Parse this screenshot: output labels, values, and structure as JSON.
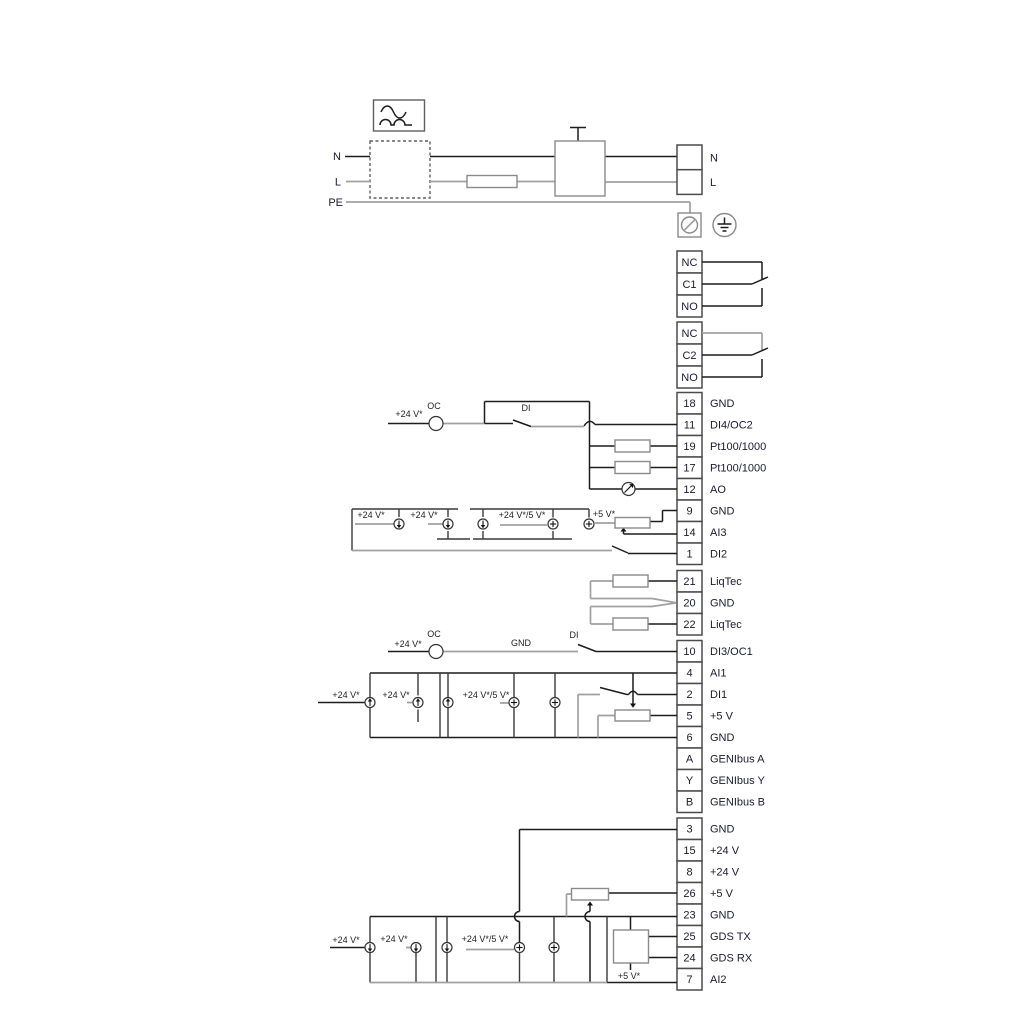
{
  "power": {
    "line_n": "N",
    "line_l": "L",
    "line_pe": "PE",
    "terminal_n": "N",
    "terminal_l": "L"
  },
  "relays": [
    {
      "cells": [
        "NC",
        "C1",
        "NO"
      ]
    },
    {
      "cells": [
        "NC",
        "C2",
        "NO"
      ]
    }
  ],
  "io": {
    "block1": [
      {
        "no": "18",
        "label": "GND"
      },
      {
        "no": "11",
        "label": "DI4/OC2"
      },
      {
        "no": "19",
        "label": "Pt100/1000"
      },
      {
        "no": "17",
        "label": "Pt100/1000"
      },
      {
        "no": "12",
        "label": "AO"
      },
      {
        "no": "9",
        "label": "GND"
      },
      {
        "no": "14",
        "label": "AI3"
      },
      {
        "no": "1",
        "label": "DI2"
      }
    ],
    "liqtec": [
      {
        "no": "21",
        "label": "LiqTec"
      },
      {
        "no": "20",
        "label": "GND"
      },
      {
        "no": "22",
        "label": "LiqTec"
      }
    ],
    "block2": [
      {
        "no": "10",
        "label": "DI3/OC1"
      },
      {
        "no": "4",
        "label": "AI1"
      },
      {
        "no": "2",
        "label": "DI1"
      },
      {
        "no": "5",
        "label": "+5 V"
      },
      {
        "no": "6",
        "label": "GND"
      },
      {
        "no": "A",
        "label": "GENIbus A"
      },
      {
        "no": "Y",
        "label": "GENIbus Y"
      },
      {
        "no": "B",
        "label": "GENIbus B"
      }
    ],
    "block3": [
      {
        "no": "3",
        "label": "GND"
      },
      {
        "no": "15",
        "label": "+24 V"
      },
      {
        "no": "8",
        "label": "+24 V"
      },
      {
        "no": "26",
        "label": "+5 V"
      },
      {
        "no": "23",
        "label": "GND"
      },
      {
        "no": "25",
        "label": "GDS TX"
      },
      {
        "no": "24",
        "label": "GDS RX"
      },
      {
        "no": "7",
        "label": "AI2"
      }
    ]
  },
  "labels": {
    "v24": "+24 V*",
    "v24_5": "+24 V*/5 V*",
    "v5": "+5 V*",
    "oc": "OC",
    "di": "DI",
    "gnd": "GND"
  },
  "colors": {
    "wire_dark": "#1c1c1c",
    "wire_gray": "#a0a0a0",
    "component": "#8a8a8a",
    "terminal_border": "#4b4b4b",
    "text": "#1a1a30",
    "background": "#ffffff"
  }
}
